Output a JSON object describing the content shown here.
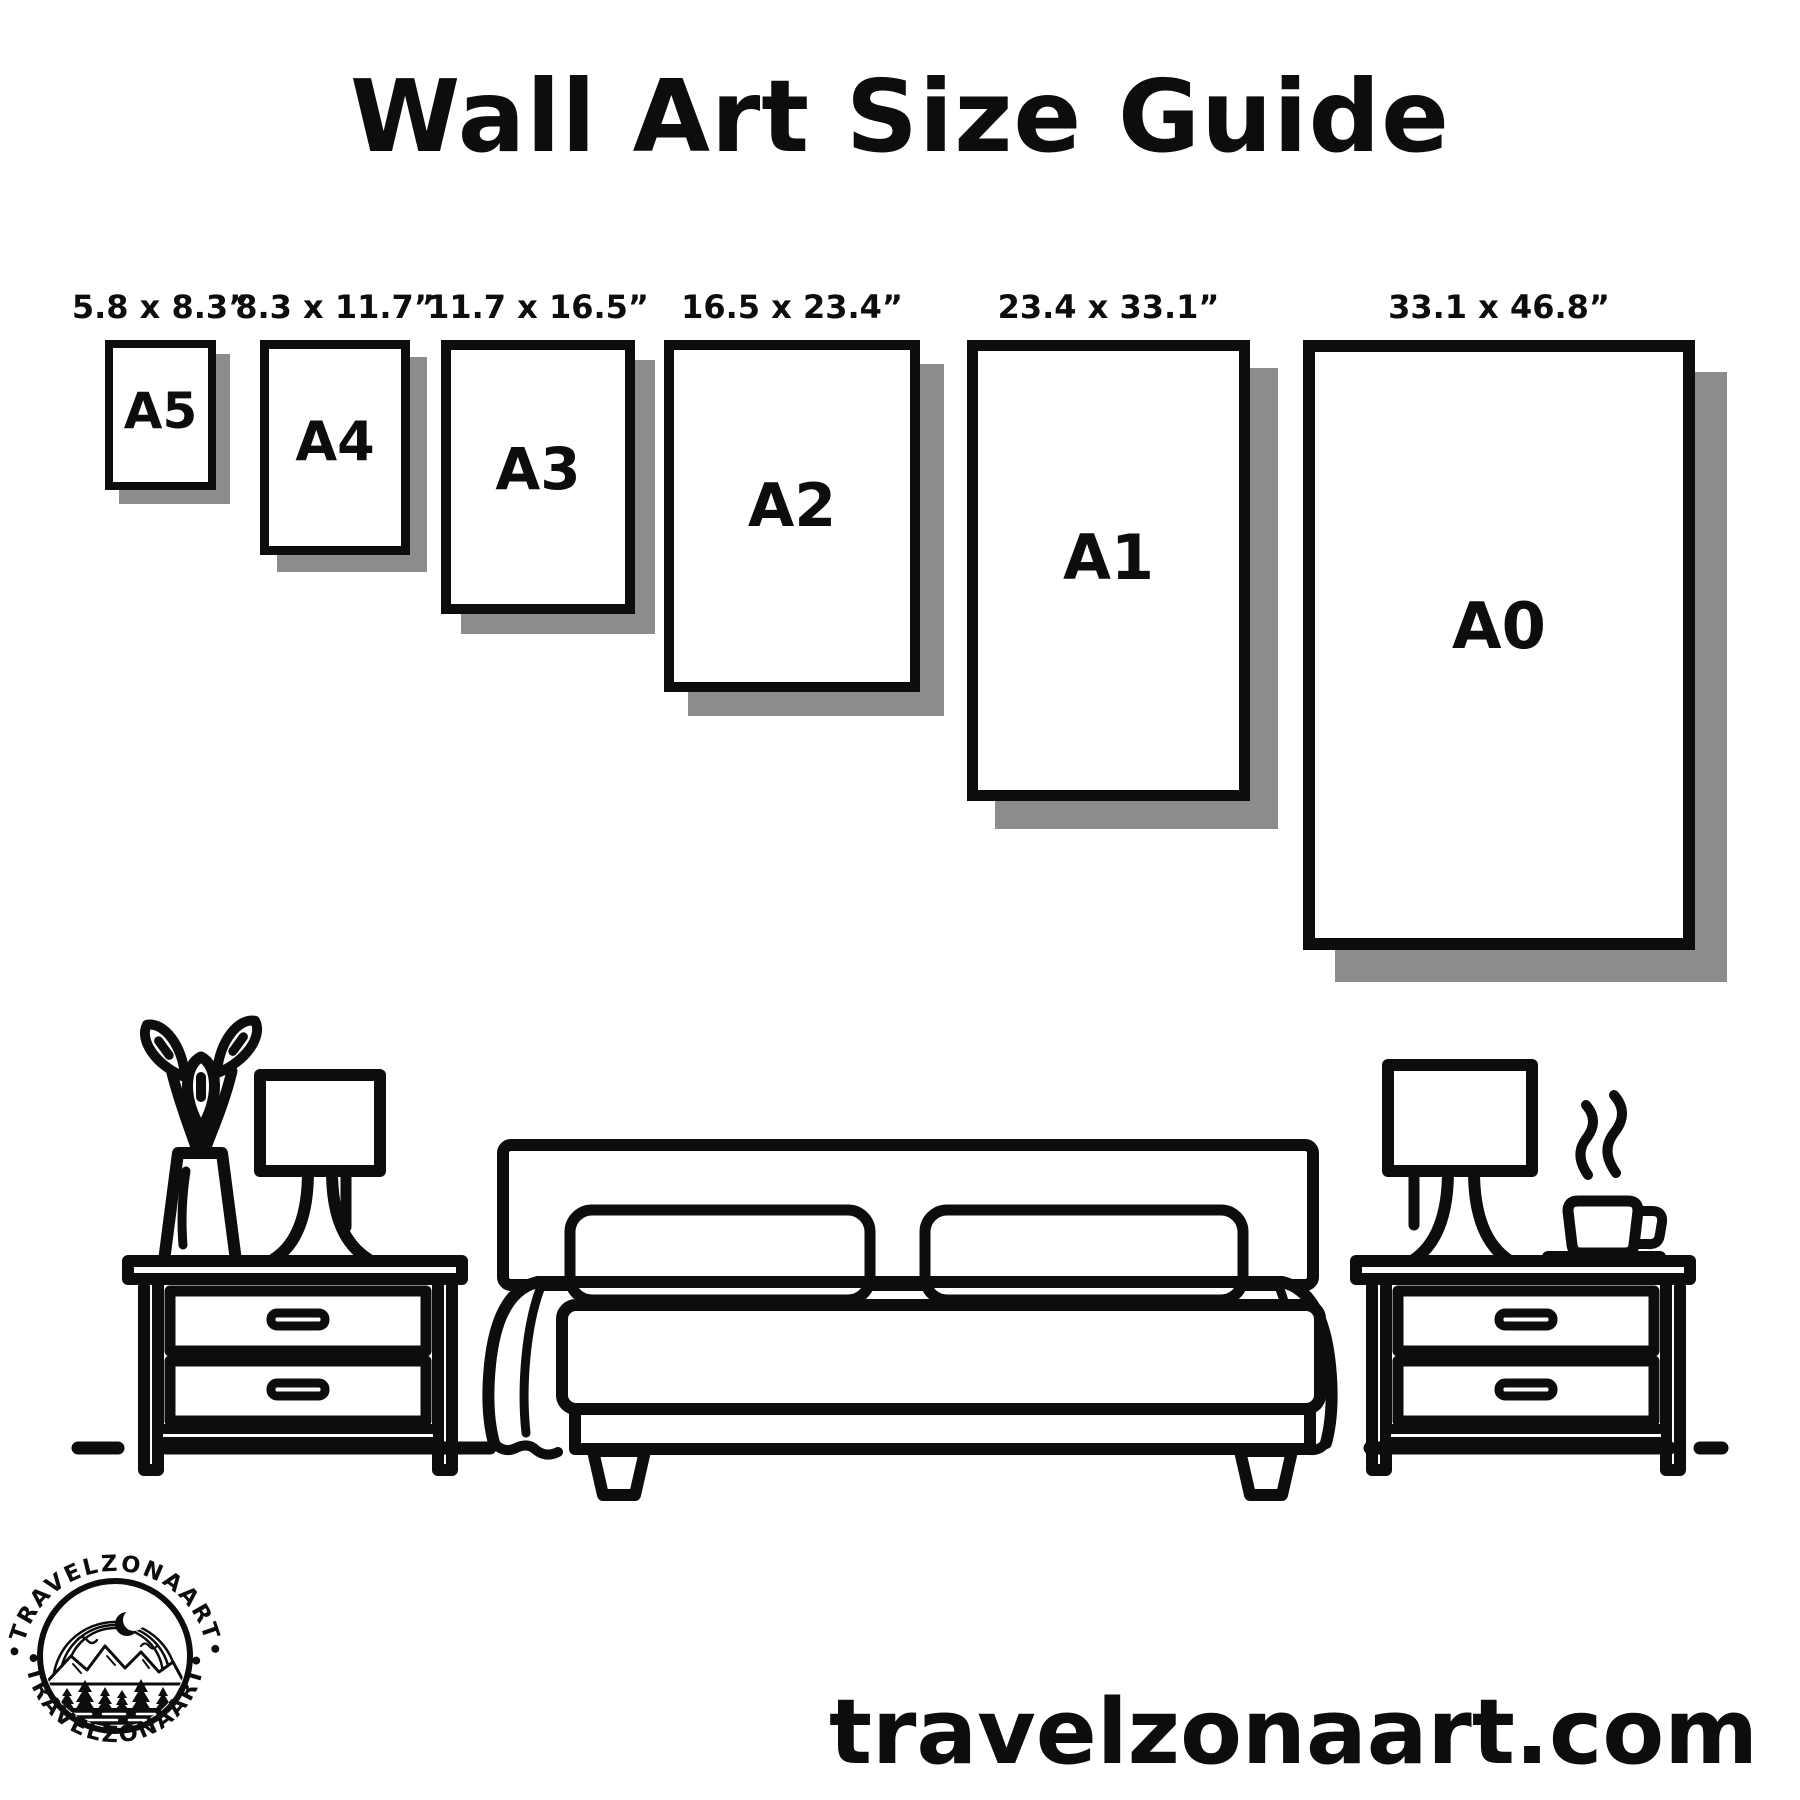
{
  "title": "Wall Art Size Guide",
  "frames": [
    {
      "size": "A5",
      "dimensions": "5.8 x 8.3”"
    },
    {
      "size": "A4",
      "dimensions": "8.3 x 11.7”"
    },
    {
      "size": "A3",
      "dimensions": "11.7 x 16.5”"
    },
    {
      "size": "A2",
      "dimensions": "16.5 x 23.4”"
    },
    {
      "size": "A1",
      "dimensions": "23.4 x 33.1”"
    },
    {
      "size": "A0",
      "dimensions": "33.1 x 46.8”"
    }
  ],
  "scene": {
    "items": [
      "flower-vase",
      "table-lamp-left",
      "nightstand-left",
      "double-bed-with-pillows",
      "table-lamp-right",
      "steaming-coffee-mug",
      "nightstand-right",
      "floor-line"
    ]
  },
  "logo": {
    "arc_text_top": "•TRAVELZONAART•",
    "arc_text_bottom": "•TRAVELZONAART•"
  },
  "footer": {
    "website": "travelzonaart.com"
  },
  "colors": {
    "ink": "#0d0d0d",
    "background": "#ffffff",
    "shadow": "#8c8c8c"
  }
}
